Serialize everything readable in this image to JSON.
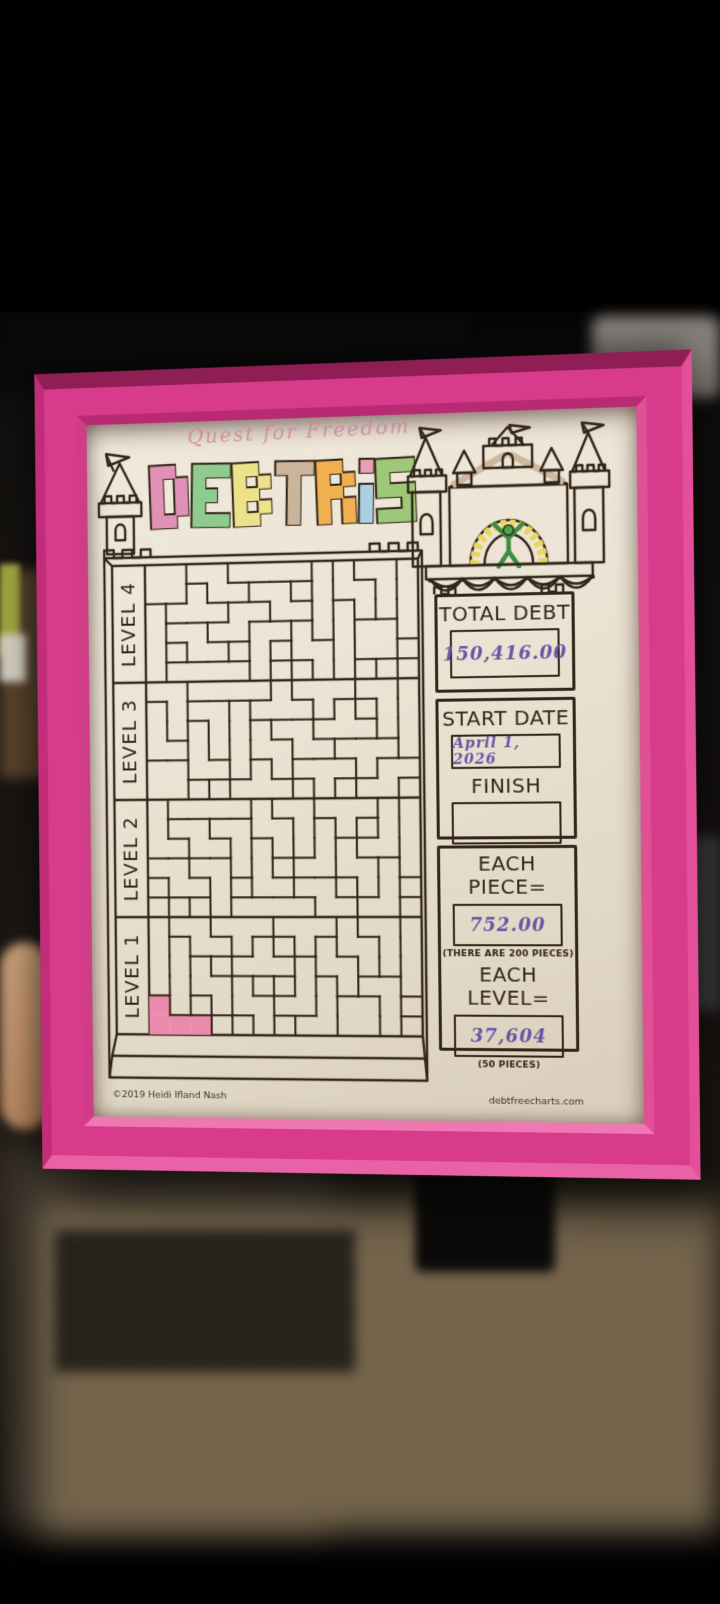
{
  "scene": {
    "photo_background": "#000000",
    "frame_color": "#d83a8c",
    "paper_color": "#ece3d4",
    "ink_color": "#32261a",
    "handwriting_ink_color": "#6b54a6"
  },
  "chart": {
    "handwritten_title": "Quest for Freedom",
    "title_letters": [
      {
        "char": "D",
        "color": "#e190b6"
      },
      {
        "char": "E",
        "color": "#8fca8e"
      },
      {
        "char": "B",
        "color": "#ece28a"
      },
      {
        "char": "T",
        "color": "#cab49c"
      },
      {
        "char": "R",
        "color": "#f0b050"
      },
      {
        "char": "i",
        "color": "#abd0e3",
        "dot_color": "#e8a0b8"
      },
      {
        "char": "S",
        "color": "#9cc878"
      }
    ],
    "levels": [
      {
        "label": "LEVEL 4"
      },
      {
        "label": "LEVEL 3"
      },
      {
        "label": "LEVEL 2"
      },
      {
        "label": "LEVEL 1"
      }
    ],
    "panel": {
      "total_debt_label": "TOTAL DEBT",
      "total_debt_value": "150,416.00",
      "start_date_label": "START DATE",
      "start_date_value": "April 1, 2026",
      "finish_label": "FINISH",
      "finish_value": "",
      "each_piece_label": "EACH PIECE=",
      "each_piece_value": "752.00",
      "each_piece_note": "(THERE ARE 200 PIECES)",
      "each_level_label": "EACH LEVEL=",
      "each_level_value": "37,604",
      "each_level_note": "(50 PIECES)"
    },
    "credits": {
      "copyright": "©2019 Heidi Ifland Nash",
      "website": "debtfreecharts.com"
    },
    "progress": {
      "filled_pieces": 1,
      "fill_color": "#ec8aae"
    },
    "board": {
      "levels_count": 4,
      "cols": 13,
      "rows_per_level": 6
    }
  }
}
